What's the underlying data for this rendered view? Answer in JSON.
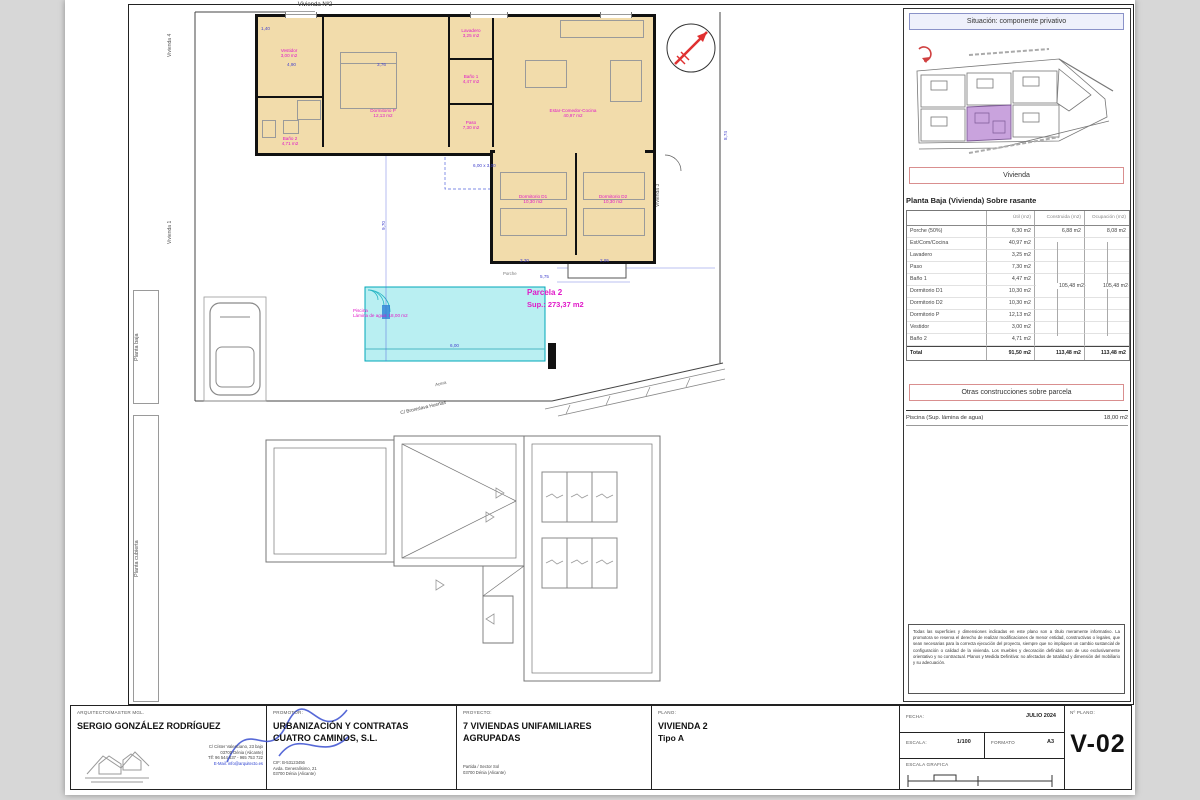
{
  "plan": {
    "top_label": "Vivienda Nº2",
    "left_top_label": "Vivienda 4",
    "left_bottom_label": "Vivienda 1",
    "right_label": "Vivienda 3",
    "margin_top_label": "Planta baja",
    "margin_bottom_label": "Planta cubierta",
    "parcel_title": "Parcela 2",
    "parcel_area": "Sup.: 273,37 m2",
    "pool_line1": "Piscina",
    "pool_line2": "Lámina de agua: 18,00 m2",
    "porche": "Porche",
    "street": "C/ Bronislava Huertas",
    "acera": "Acera",
    "rooms": {
      "vestidor": {
        "label": "Vestidor",
        "area": "3,00 m2"
      },
      "bano2": {
        "label": "Baño 2",
        "area": "4,71 m2"
      },
      "dormP": {
        "label": "Dormitorio P",
        "area": "12,13 m2"
      },
      "estar": {
        "label": "Estar-Comedor-Cocina",
        "area": "40,97 m2"
      },
      "lavadero": {
        "label": "Lavadero",
        "area": "3,25 m2"
      },
      "bano1": {
        "label": "Baño 1",
        "area": "4,47 m2"
      },
      "paso": {
        "label": "Paso",
        "area": "7,30 m2"
      },
      "d1": {
        "label": "Dormitorio D1",
        "area": "10,30 m2"
      },
      "d2": {
        "label": "Dormitorio D2",
        "area": "10,30 m2"
      }
    },
    "dims": {
      "a": "4,90",
      "b": "3,76",
      "c": "1,40",
      "d": "3,30",
      "e": "2,95",
      "f": "5,75",
      "g": "8,74",
      "h": "9,70",
      "i": "6,00",
      "j": "6,00 x 3,00"
    }
  },
  "situacion": {
    "title": "Situación: componente privativo"
  },
  "vivienda_panel": {
    "title": "Vivienda",
    "subtitle": "Planta Baja (Vivienda) Sobre rasante",
    "columns": {
      "util": "Útil (m2)",
      "construida": "Construida (m2)",
      "ocupacion": "Ocupación (m2)"
    },
    "rows": [
      {
        "name": "Porche (50%)",
        "util": "6,30 m2",
        "constr": "6,88 m2",
        "ocup": "8,08 m2"
      },
      {
        "name": "Est/Com/Cocina",
        "util": "40,97 m2"
      },
      {
        "name": "Lavadero",
        "util": "3,25 m2"
      },
      {
        "name": "Paso",
        "util": "7,30 m2"
      },
      {
        "name": "Baño 1",
        "util": "4,47 m2"
      },
      {
        "name": "Dormitorio D1",
        "util": "10,30 m2"
      },
      {
        "name": "Dormitorio D2",
        "util": "10,30 m2"
      },
      {
        "name": "Dormitorio P",
        "util": "12,13 m2"
      },
      {
        "name": "Vestidor",
        "util": "3,00 m2"
      },
      {
        "name": "Baño 2",
        "util": "4,71 m2"
      }
    ],
    "merged_construida": "105,48 m2",
    "merged_ocupada": "105,48 m2",
    "total_label": "Total",
    "total_util": "91,50 m2",
    "total_construida": "113,48 m2",
    "total_ocupada": "113,48 m2"
  },
  "otras": {
    "title": "Otras construcciones sobre parcela",
    "item": "Piscina (Sup. lámina de agua)",
    "value": "18,00 m2"
  },
  "disclaimer": "Todas las superficies y dimensiones indicadas en este plano son a título meramente informativo. La promotora se reserva el derecho de realizar modificaciones de menor entidad, constructivas o legales, que sean necesarias para la correcta ejecución del proyecto, siempre que no impliquen un cambio sustancial de configuración o calidad de la vivienda. Los muebles y decoración definidos son de uso exclusivamente orientativo y no contractual. Planos y Medida Definitiva: no afectados de totalidad y dimensión del mobiliario y su adecuación.",
  "titleblock": {
    "arquitecto_label": "ARQUITECTO/MASTER MGL.",
    "arquitecto_name": "SERGIO GONZÁLEZ RODRÍGUEZ",
    "arquitecto_addr1": "C/ Císter Valenciano, 23 bajo",
    "arquitecto_addr2": "03700 Dénia (Alicante)",
    "arquitecto_addr3": "Tlf: 96 544 637 - 965 753 722",
    "arquitecto_addr4": "E-Mail: info@arquitecto.es",
    "promotor_label": "PROMOTOR:",
    "promotor_name1": "URBANIZACIÓN Y CONTRATAS",
    "promotor_name2": "CUATRO CAMINOS, S.L.",
    "promotor_addr1": "CIF: B-53123456",
    "promotor_addr2": "Avda. Generalísimo, 21",
    "promotor_addr3": "03700 Dénia (Alicante)",
    "proyecto_label": "PROYECTO:",
    "proyecto_name1": "7 VIVIENDAS UNIFAMILIARES",
    "proyecto_name2": "AGRUPADAS",
    "proyecto_addr1": "Partida / Sector Sol",
    "proyecto_addr2": "03700 Dénia (Alicante)",
    "plano_label": "PLANO:",
    "plano_name": "VIVIENDA 2",
    "plano_tipo": "Tipo A",
    "fecha_label": "FECHA:",
    "fecha_value": "JULIO 2024",
    "escala_label": "ESCALA:",
    "escala_value": "1/100",
    "formato_label": "FORMATO",
    "formato_value": "A3",
    "escala_grafica_label": "ESCALA GRAFICA",
    "nplano_label": "Nº PLANO:",
    "nplano_value": "V-02"
  }
}
